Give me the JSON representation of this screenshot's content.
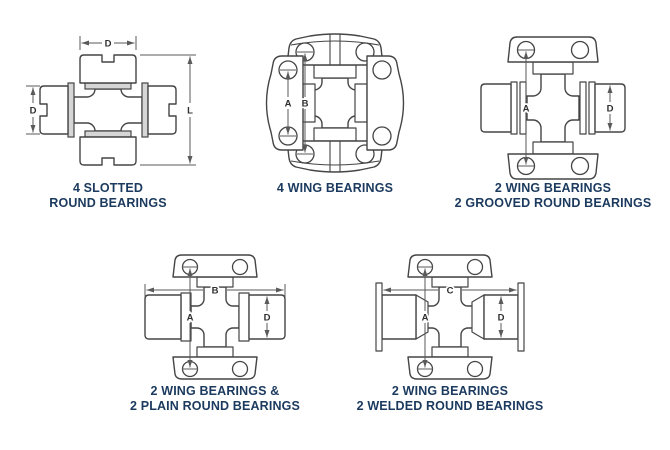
{
  "colors": {
    "background": "#ffffff",
    "line_art": "#454545",
    "caption_text": "#1b3a5e",
    "dimension_text": "#2f2f2f",
    "shading": "#d6d6d6"
  },
  "figures": [
    {
      "id": "slotted-round",
      "caption": [
        "4 SLOTTED",
        "ROUND BEARINGS"
      ],
      "dims": {
        "width_top": "D",
        "diameter_left": "D",
        "length_right": "L"
      }
    },
    {
      "id": "four-wing",
      "caption": [
        "4 WING BEARINGS"
      ],
      "dims": {
        "side_hole_span": "A",
        "vertical_hole_span": "B"
      }
    },
    {
      "id": "grooved-round",
      "caption": [
        "2 WING BEARINGS",
        "2 GROOVED ROUND BEARINGS"
      ],
      "dims": {
        "hole_span": "A",
        "diameter_right": "D"
      }
    },
    {
      "id": "plain-round",
      "caption": [
        "2 WING BEARINGS &",
        "2 PLAIN ROUND BEARINGS"
      ],
      "dims": {
        "width_top": "B",
        "hole_span": "A",
        "diameter_right": "D"
      }
    },
    {
      "id": "welded-round",
      "caption": [
        "2 WING BEARINGS",
        "2 WELDED ROUND BEARINGS"
      ],
      "dims": {
        "width_top": "C",
        "hole_span": "A",
        "diameter_right": "D"
      }
    }
  ]
}
